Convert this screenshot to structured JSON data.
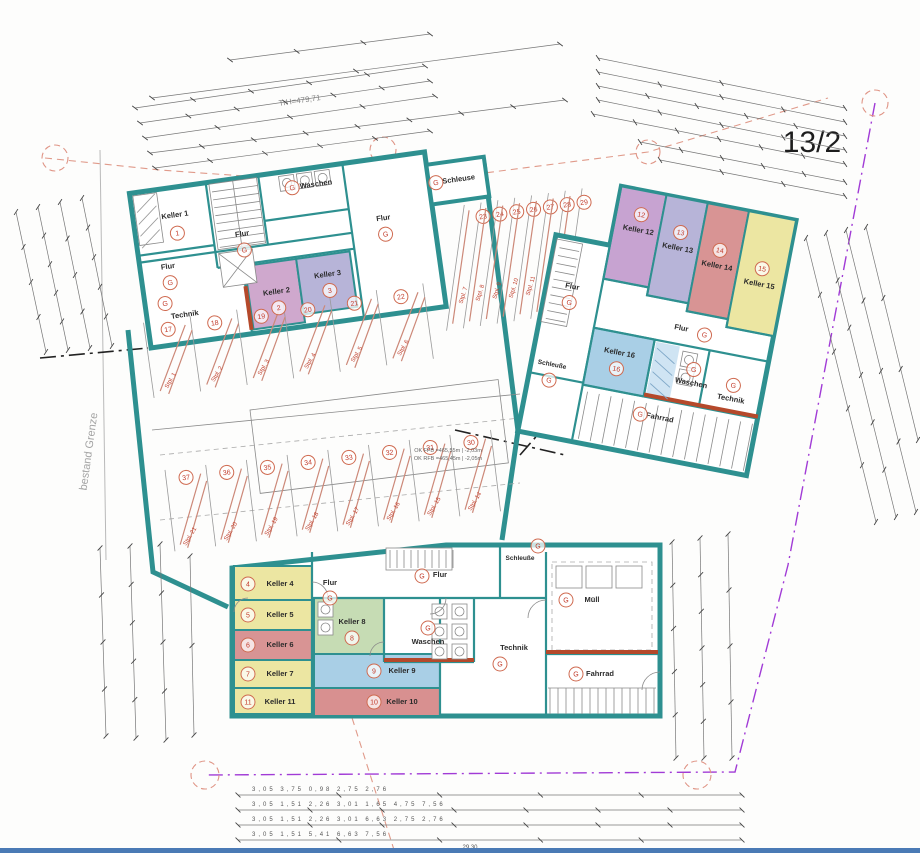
{
  "annotations": {
    "parcel": "13/2",
    "grenze": "bestand Grenze",
    "trh": "TrH=479,71",
    "ok1": "OK FFB =465,55m | -2,03m",
    "ok2": "OK RFB =465,45m | -2,05m"
  },
  "badges": {
    "g": "G"
  },
  "palette": {
    "teal": "#2e9090",
    "accent": "#b5492b",
    "hatch": "#cc8878",
    "purple": "#c7a3d1",
    "mauve": "#cfa8cd",
    "lavender": "#b7b4d8",
    "salmon": "#d89494",
    "yellow": "#ece6a2",
    "green": "#c6dcb4",
    "blue": "#a9cfe6",
    "red": "#d89090",
    "bluehatch": "#cfe4f3"
  },
  "rooms": {
    "k1": {
      "name": "Keller 1",
      "num": "1"
    },
    "k2": {
      "name": "Keller 2",
      "num": "2"
    },
    "k3": {
      "name": "Keller 3",
      "num": "3"
    },
    "k4": {
      "name": "Keller 4",
      "num": "4"
    },
    "k5": {
      "name": "Keller 5",
      "num": "5"
    },
    "k6": {
      "name": "Keller 6",
      "num": "6"
    },
    "k7": {
      "name": "Keller 7",
      "num": "7"
    },
    "k8": {
      "name": "Keller 8",
      "num": "8"
    },
    "k9": {
      "name": "Keller 9",
      "num": "9"
    },
    "k10": {
      "name": "Keller 10",
      "num": "10"
    },
    "k11": {
      "name": "Keller 11",
      "num": "11"
    },
    "k12": {
      "name": "Keller 12",
      "num": "12"
    },
    "k13": {
      "name": "Keller 13",
      "num": "13"
    },
    "k14": {
      "name": "Keller 14",
      "num": "14"
    },
    "k15": {
      "name": "Keller 15",
      "num": "15"
    },
    "k16": {
      "name": "Keller 16",
      "num": "16"
    },
    "flur": "Flur",
    "waschen": "Waschen",
    "technik": "Technik",
    "schleuse": "Schleuse",
    "schleusse": "Schleuße",
    "fahrrad": "Fahrrad",
    "muell": "Müll"
  },
  "parking": {
    "spots": [
      {
        "label": "Stpl. 1",
        "badge": "17"
      },
      {
        "label": "Stpl. 2",
        "badge": "18"
      },
      {
        "label": "Stpl. 3",
        "badge": "19"
      },
      {
        "label": "Stpl. 4",
        "badge": "20"
      },
      {
        "label": "Stpl. 5",
        "badge": "21"
      },
      {
        "label": "Stpl. 6",
        "badge": "22"
      },
      {
        "label": "Stpl. 7",
        "badge": "23"
      },
      {
        "label": "Stpl. 8",
        "badge": "24"
      },
      {
        "label": "Stpl. 9",
        "badge": "25"
      },
      {
        "label": "Stpl. 10",
        "badge": "26"
      },
      {
        "label": "Stpl. 11",
        "badge": "27"
      },
      {
        "label": "Stpl. 12",
        "badge": "28"
      },
      {
        "label": "Stpl. 13",
        "badge": "29"
      },
      {
        "label": "Stpl. 14",
        "badge": "30"
      },
      {
        "label": "Stpl. 15",
        "badge": "31"
      },
      {
        "label": "Stpl. 16",
        "badge": "32"
      },
      {
        "label": "Stpl. 17",
        "badge": "33"
      },
      {
        "label": "Stpl. 18",
        "badge": "34"
      },
      {
        "label": "Stpl. 19",
        "badge": "35"
      },
      {
        "label": "Stpl. 20",
        "badge": "36"
      },
      {
        "label": "Stpl. 21",
        "badge": "37"
      }
    ]
  },
  "dims": {
    "r1": "3,05      3,75      0,98      2,75      2,76",
    "r2": "3,05   1,51   2,26   3,01   1,65   4,75   7,56",
    "r3": "3,05   1,51   2,26   3,01   6,63   2,75   2,76",
    "r4": "3,05   1,51   5,41   6,63   7,56",
    "total": "29,30"
  }
}
